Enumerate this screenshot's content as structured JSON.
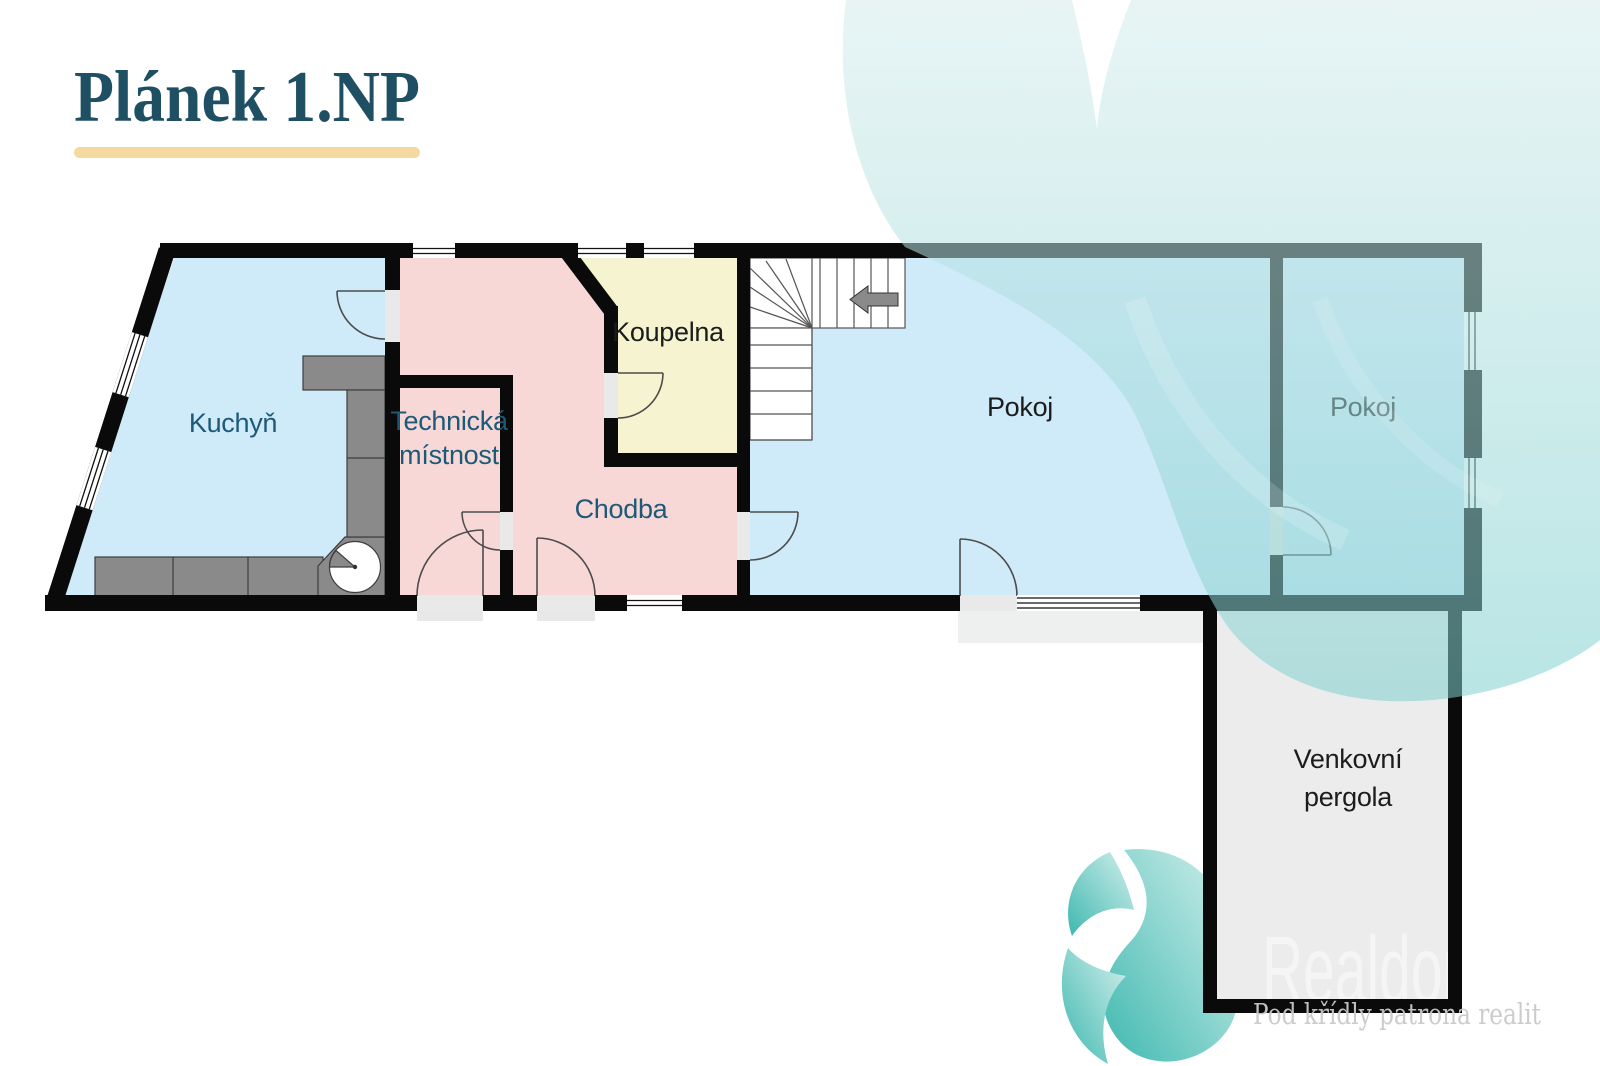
{
  "title": {
    "text": "Plánek 1.NP"
  },
  "floor_plan": {
    "rooms": [
      {
        "id": "kuchyn",
        "label": "Kuchyň"
      },
      {
        "id": "technicka-mistnost",
        "label": "Technická místnost",
        "line1": "Technická",
        "line2": "místnost"
      },
      {
        "id": "koupelna",
        "label": "Koupelna"
      },
      {
        "id": "chodba",
        "label": "Chodba"
      },
      {
        "id": "pokoj-large",
        "label": "Pokoj"
      },
      {
        "id": "pokoj-right",
        "label": "Pokoj"
      },
      {
        "id": "venkovni-pergola",
        "label": "Venkovní pergola",
        "line1": "Venkovní",
        "line2": "pergola"
      }
    ],
    "colors": {
      "wall": "#0a0a0a",
      "room_blue": "#cfeaf8",
      "room_pink": "#f8d7d7",
      "room_yellow": "#f5f3d0",
      "room_pergola": "#ececec",
      "door_gap": "#e9e9e9",
      "counter_gray": "#8a8a8a",
      "label_teal": "#1d5a78",
      "label_dark": "#1c1c1c",
      "title_color": "#1f4f63",
      "underline": "#f4d9a0",
      "decor_teal": "#7fcfcf",
      "watermark_white": "#ffffff",
      "tagline_gray": "#c9c9c9"
    }
  },
  "watermark": {
    "brand": "Realdom",
    "tagline": "Pod křídly patrona realit"
  }
}
